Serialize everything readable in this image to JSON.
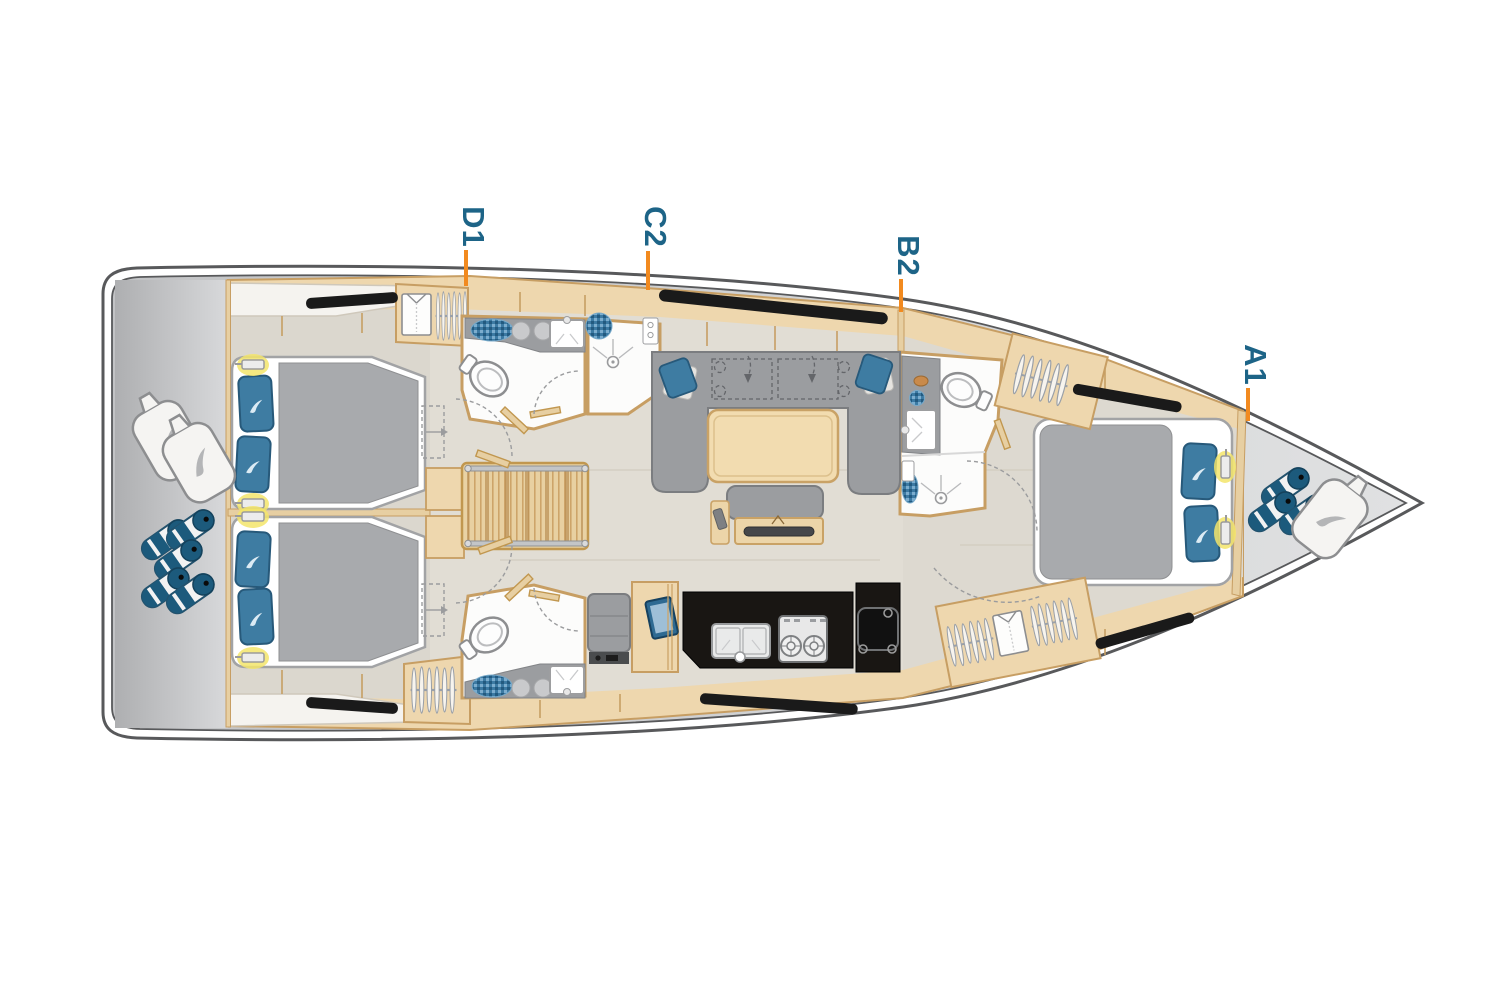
{
  "plan": {
    "cabin_labels": [
      {
        "id": "D1"
      },
      {
        "id": "C2"
      },
      {
        "id": "B2"
      },
      {
        "id": "A1"
      }
    ]
  },
  "colors": {
    "label_text": "#1d6487",
    "label_tick": "#f28a1f",
    "hull_outline": "#58595b",
    "deck_gray": "#c3c4c6",
    "wood": "#eed7ae",
    "wood_border": "#c79e63",
    "floor": "#e1ddd4",
    "furniture_gray": "#9b9da0",
    "bed_blanket_gray": "#a8aaad",
    "pillow_blue": "#3e7ca2",
    "fender_blue": "#1c5a7c",
    "galley_counter_black": "#191613",
    "hull_window_black": "#1a1a1a",
    "reading_light_yellow": "#f3e56b"
  },
  "icons": {
    "brand_swoosh": "curved-leaf-swoosh",
    "rolled_fender": "striped-cylinder",
    "fender_bag": "soft-bag-with-swoosh",
    "clothes_hangers": "hanger-rail",
    "folded_shirt": "folded-shirt",
    "toilet": "oval-bowl-with-tank",
    "shower_drain": "circle-with-spray-lines",
    "reading_light": "bar-with-yellow-glow"
  }
}
